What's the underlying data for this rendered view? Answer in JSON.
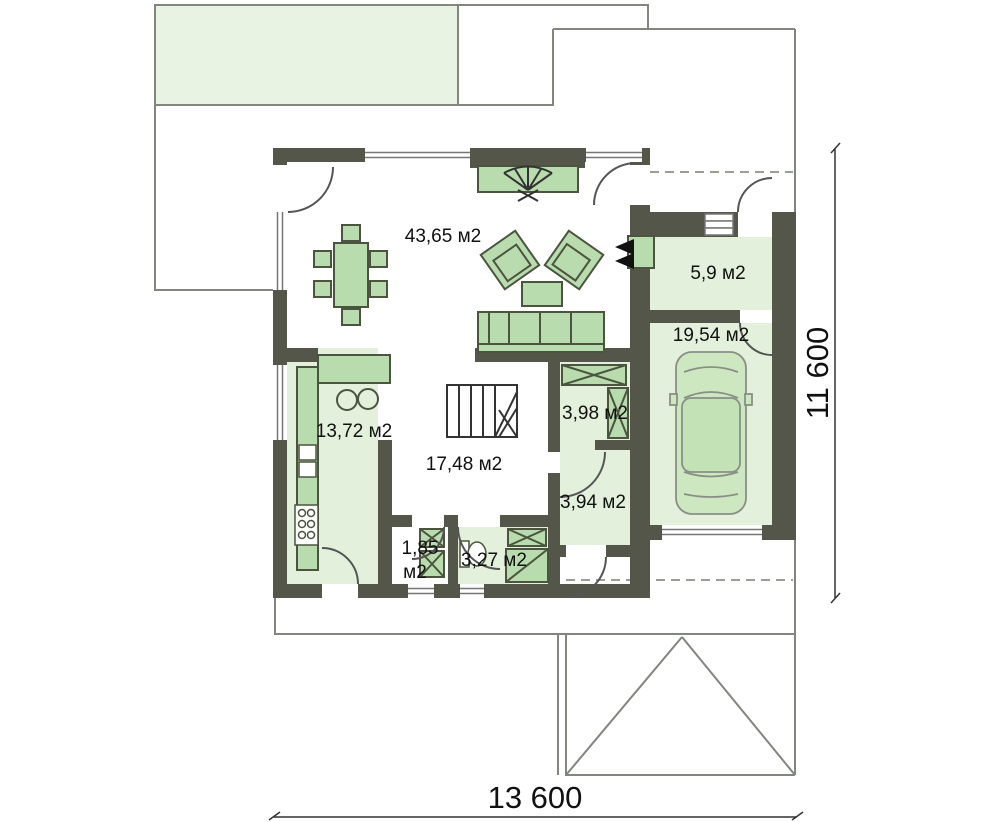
{
  "plan": {
    "type": "house-floor-plan",
    "floor": "ground floor",
    "units": "м2"
  },
  "labels": {
    "living": "43,65 м2",
    "entry": "5,9 м2",
    "garage": "19,54 м2",
    "kitchen": "13,72 м2",
    "wardrobe": "3,98 м2",
    "hall": "17,48 м2",
    "utility": "3,94 м2",
    "wc_line1": "1,85",
    "wc_line2": "м2",
    "bathroom": "3,27 м2"
  },
  "dimensions": {
    "width": "13 600",
    "height": "11 600"
  },
  "colors": {
    "wall": "#54564a",
    "floor_green": "#e3f0dc",
    "furniture_green": "#b9dcae",
    "roof_outline_fill": "#e9f3e4",
    "outline_stroke": "#82867d",
    "text": "#111111"
  }
}
